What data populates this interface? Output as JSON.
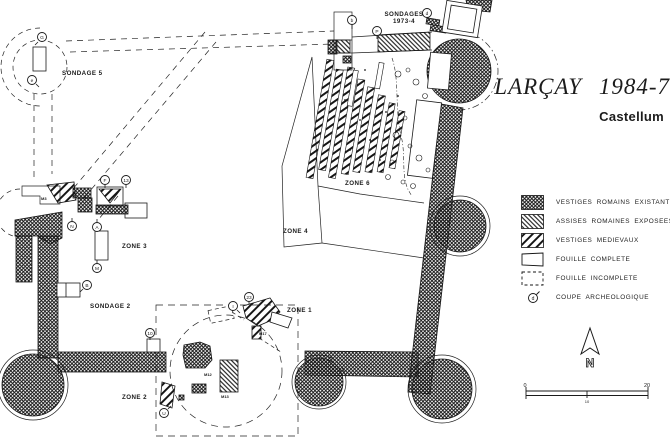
{
  "title": {
    "main": "LARÇAY 1984-7",
    "subtitle": "Castellum"
  },
  "legend": {
    "items": [
      {
        "label": "VESTIGES ROMAINS EXISTANTS",
        "swatch": "roman-crosshatch"
      },
      {
        "label": "ASSISES ROMAINES EXPOSEES",
        "swatch": "dense-backslash-hatch"
      },
      {
        "label": "VESTIGES MEDIEVAUX",
        "swatch": "wide-slash-hatch"
      },
      {
        "label": "FOUILLE COMPLETE",
        "swatch": "solid-outline-square"
      },
      {
        "label": "FOUILLE INCOMPLETE",
        "swatch": "dashed-outline-square"
      },
      {
        "label": "COUPE ARCHEOLOGIQUE",
        "swatch": "circled-letter-symbol",
        "symbol_letter": "d"
      }
    ]
  },
  "plan": {
    "area_labels": [
      {
        "text": "SONDAGE 5"
      },
      {
        "text": "SONDAGES"
      },
      {
        "text": "1973-4"
      },
      {
        "text": "ZONE 6"
      },
      {
        "text": "ZONE 4"
      },
      {
        "text": "ZONE 3"
      },
      {
        "text": "SONDAGE 2"
      },
      {
        "text": "ZONE 1"
      },
      {
        "text": "ZONE 2"
      }
    ],
    "small_labels": [
      {
        "text": "M3"
      },
      {
        "text": "M12"
      },
      {
        "text": "M13"
      },
      {
        "text": "M17"
      }
    ],
    "section_markers": [
      {
        "letter": "G"
      },
      {
        "letter": "e"
      },
      {
        "letter": "b"
      },
      {
        "letter": "P"
      },
      {
        "letter": "d"
      },
      {
        "letter": "F"
      },
      {
        "letter": "13"
      },
      {
        "letter": "A"
      },
      {
        "letter": "N"
      },
      {
        "letter": "M"
      },
      {
        "letter": "B"
      },
      {
        "letter": "10"
      },
      {
        "letter": "23"
      },
      {
        "letter": "I"
      },
      {
        "letter": "U"
      }
    ]
  },
  "north_arrow": {
    "label": "N"
  },
  "scale_bar": {
    "start": "0",
    "mid": "10",
    "end": "20"
  },
  "colors": {
    "ink": "#1a1a1a",
    "paper": "#ffffff"
  }
}
